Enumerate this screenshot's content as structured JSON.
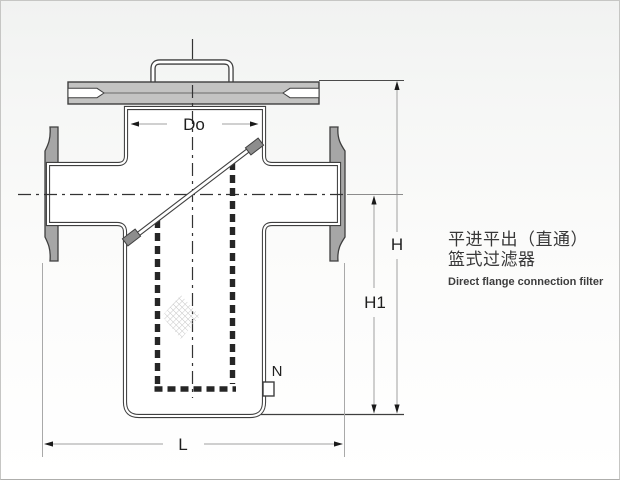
{
  "product": {
    "name_cn_line1": "平进平出（直通）",
    "name_cn_line2": "篮式过滤器",
    "name_en": "Direct flange connection filter"
  },
  "diagram": {
    "labels": {
      "basket_diameter": "Do",
      "total_height": "H",
      "center_height": "H1",
      "face_to_face_length": "L",
      "drain_port": "N"
    }
  },
  "colors": {
    "flange_gray": "#a6a6a6",
    "cover_gray": "#c3c3c2",
    "clamp_gray": "#8d8d8d",
    "outline": "#3f3f3f",
    "dim_line": "#a0a0a0",
    "hatch": "#c3c3c3"
  }
}
